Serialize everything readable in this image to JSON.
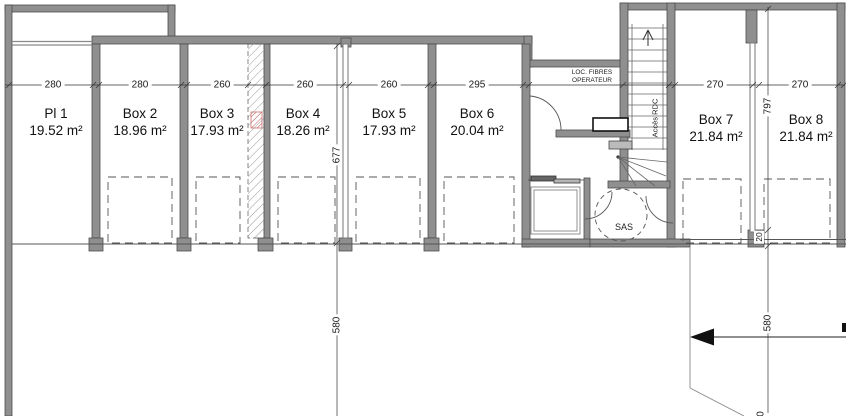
{
  "plan": {
    "title": "Basement parking boxes floor plan",
    "rooms": [
      {
        "name": "Pl 1",
        "area": "19.52 m²"
      },
      {
        "name": "Box 2",
        "area": "18.96 m²"
      },
      {
        "name": "Box 3",
        "area": "17.93 m²"
      },
      {
        "name": "Box 4",
        "area": "18.26 m²"
      },
      {
        "name": "Box 5",
        "area": "17.93 m²"
      },
      {
        "name": "Box 6",
        "area": "20.04 m²"
      },
      {
        "name": "Box 7",
        "area": "21.84 m²"
      },
      {
        "name": "Box 8",
        "area": "21.84 m²"
      }
    ],
    "labels": {
      "loc_fibres_line1": "LOC. FIBRES",
      "loc_fibres_line2": "OPERATEUR",
      "acces_rdc": "Accès RDC",
      "sas": "SAS"
    },
    "dims": {
      "h": [
        "280",
        "280",
        "260",
        "260",
        "260",
        "295",
        "270",
        "270"
      ],
      "v_left_upper": "677",
      "v_left_lower": "580",
      "v_right_upper": "797",
      "v_right_lower": "580",
      "v_wall": "20",
      "v_cut": "0"
    },
    "colors": {
      "wall_fill": "#8f8f8f",
      "wall_outline": "#4d4d4d",
      "line": "#3a3a3a",
      "hatch_red": "#cc6f6f"
    }
  }
}
